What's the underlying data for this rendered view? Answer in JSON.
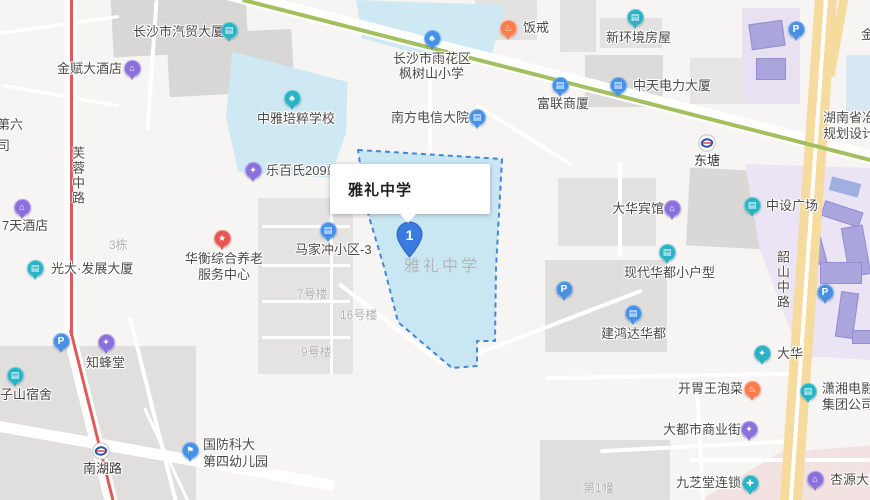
{
  "map": {
    "selected_poi": {
      "tooltip_label": "雅礼中学",
      "marker_number": "1",
      "campus_ghost_label": "雅礼中学"
    },
    "colors": {
      "teal": "#2ab3c4",
      "blue": "#4691e8",
      "purple": "#8a70dd",
      "red": "#e8544f",
      "orange": "#fa7c4b",
      "parking": "#4a90e2",
      "campus_fill": "#c9e6f3",
      "campus_border": "#4287d6",
      "metro_line_green": "#a3bf5f",
      "road_yellow": "#f6db9e",
      "route_red": "#e05a58"
    },
    "pois": [
      {
        "name": "qimao-building",
        "icon": {
          "x": 229,
          "y": 30,
          "color": "teal",
          "glyph": "building"
        },
        "lines": [
          {
            "t": "长沙市汽贸大厦",
            "x": 133,
            "y": 24
          }
        ]
      },
      {
        "name": "jinfu-hotel",
        "icon": {
          "x": 132,
          "y": 68,
          "color": "purple",
          "glyph": "hotel"
        },
        "lines": [
          {
            "t": "金赋大酒店",
            "x": 57,
            "y": 61
          }
        ]
      },
      {
        "name": "fanjie",
        "icon": {
          "x": 508,
          "y": 28,
          "color": "orange",
          "glyph": "food"
        },
        "lines": [
          {
            "t": "饭戒",
            "x": 523,
            "y": 20
          }
        ]
      },
      {
        "name": "xinhuanjing-house",
        "icon": {
          "x": 635,
          "y": 17,
          "color": "teal",
          "glyph": "building"
        },
        "lines": [
          {
            "t": "新环境房屋",
            "x": 606,
            "y": 30
          }
        ]
      },
      {
        "name": "fengshushan-school",
        "icon": {
          "x": 432,
          "y": 38,
          "color": "blue",
          "glyph": "school"
        },
        "lines": [
          {
            "t": "长沙市雨花区",
            "x": 393,
            "y": 51
          },
          {
            "t": "枫树山小学",
            "x": 399,
            "y": 66
          }
        ]
      },
      {
        "name": "fulian-building",
        "icon": {
          "x": 560,
          "y": 85,
          "color": "blue",
          "glyph": "building"
        },
        "lines": [
          {
            "t": "富联商厦",
            "x": 537,
            "y": 96
          }
        ]
      },
      {
        "name": "zhongtian-power",
        "icon": {
          "x": 618,
          "y": 85,
          "color": "blue",
          "glyph": "building"
        },
        "lines": [
          {
            "t": "中天电力大厦",
            "x": 633,
            "y": 78
          }
        ]
      },
      {
        "name": "hunan-institute",
        "lines": [
          {
            "t": "湖南省冶",
            "x": 823,
            "y": 110
          },
          {
            "t": "规划设计",
            "x": 823,
            "y": 126
          }
        ]
      },
      {
        "name": "zhongya-school",
        "icon": {
          "x": 292,
          "y": 98,
          "color": "teal",
          "glyph": "school"
        },
        "lines": [
          {
            "t": "中雅培粹学校",
            "x": 257,
            "y": 111
          }
        ]
      },
      {
        "name": "nanfang-telecom",
        "icon": {
          "x": 477,
          "y": 117,
          "color": "blue",
          "glyph": "building"
        },
        "lines": [
          {
            "t": "南方电信大院",
            "x": 391,
            "y": 110
          }
        ]
      },
      {
        "name": "lebaishi-209",
        "icon": {
          "x": 253,
          "y": 170,
          "color": "purple",
          "glyph": "shop"
        },
        "lines": [
          {
            "t": "乐百氏209站",
            "x": 266,
            "y": 163
          }
        ]
      },
      {
        "name": "dahua-hotel",
        "icon": {
          "x": 672,
          "y": 208,
          "color": "purple",
          "glyph": "hotel"
        },
        "lines": [
          {
            "t": "大华宾馆",
            "x": 612,
            "y": 201
          }
        ]
      },
      {
        "name": "zhongshe-plaza",
        "icon": {
          "x": 752,
          "y": 205,
          "color": "teal",
          "glyph": "building"
        },
        "lines": [
          {
            "t": "中设广场",
            "x": 766,
            "y": 198
          }
        ]
      },
      {
        "name": "majiachong-3",
        "icon": {
          "x": 328,
          "y": 230,
          "color": "blue",
          "glyph": "building"
        },
        "lines": [
          {
            "t": "马家冲小区-3",
            "x": 295,
            "y": 242
          }
        ]
      },
      {
        "name": "xiandai-huadu",
        "icon": {
          "x": 667,
          "y": 252,
          "color": "teal",
          "glyph": "building"
        },
        "lines": [
          {
            "t": "现代华都小户型",
            "x": 624,
            "y": 265
          }
        ]
      },
      {
        "name": "huaheng-center",
        "icon": {
          "x": 222,
          "y": 238,
          "color": "red",
          "glyph": "star"
        },
        "lines": [
          {
            "t": "华衡综合养老",
            "x": 185,
            "y": 251
          },
          {
            "t": "服务中心",
            "x": 198,
            "y": 267
          }
        ]
      },
      {
        "name": "guangda-building",
        "icon": {
          "x": 35,
          "y": 268,
          "color": "teal",
          "glyph": "building"
        },
        "lines": [
          {
            "t": "光大·发展大厦",
            "x": 51,
            "y": 261
          }
        ]
      },
      {
        "name": "7days-hotel",
        "icon": {
          "x": 22,
          "y": 207,
          "color": "purple",
          "glyph": "hotel"
        },
        "lines": [
          {
            "t": "7天酒店",
            "x": 2,
            "y": 218
          }
        ]
      },
      {
        "name": "zhifengtang",
        "icon": {
          "x": 106,
          "y": 342,
          "color": "purple",
          "glyph": "shop"
        },
        "lines": [
          {
            "t": "知蜂堂",
            "x": 86,
            "y": 355
          }
        ]
      },
      {
        "name": "zishan-dorm",
        "icon": {
          "x": 15,
          "y": 375,
          "color": "teal",
          "glyph": "building"
        },
        "lines": [
          {
            "t": "子山宿舍",
            "x": 0,
            "y": 387
          }
        ]
      },
      {
        "name": "jianhongda-huadu",
        "icon": {
          "x": 633,
          "y": 313,
          "color": "blue",
          "glyph": "building"
        },
        "lines": [
          {
            "t": "建鸿达华都",
            "x": 601,
            "y": 326
          }
        ]
      },
      {
        "name": "dahua",
        "icon": {
          "x": 762,
          "y": 353,
          "color": "teal",
          "glyph": "shop"
        },
        "lines": [
          {
            "t": "大华",
            "x": 777,
            "y": 346
          }
        ]
      },
      {
        "name": "kaiweiwang-paocai",
        "icon": {
          "x": 752,
          "y": 389,
          "color": "orange",
          "glyph": "food"
        },
        "lines": [
          {
            "t": "开胃王泡菜",
            "x": 678,
            "y": 381
          }
        ]
      },
      {
        "name": "xiaoxiang-film",
        "icon": {
          "x": 808,
          "y": 391,
          "color": "teal",
          "glyph": "building"
        },
        "lines": [
          {
            "t": "潇湘电影",
            "x": 822,
            "y": 381
          },
          {
            "t": "集团公司",
            "x": 822,
            "y": 397
          }
        ]
      },
      {
        "name": "dadushi-street",
        "icon": {
          "x": 749,
          "y": 429,
          "color": "purple",
          "glyph": "shop"
        },
        "lines": [
          {
            "t": "大都市商业街",
            "x": 663,
            "y": 422
          }
        ]
      },
      {
        "name": "jiuzhitang",
        "icon": {
          "x": 750,
          "y": 483,
          "color": "teal",
          "glyph": "pharmacy"
        },
        "lines": [
          {
            "t": "九芝堂连锁",
            "x": 676,
            "y": 475
          }
        ]
      },
      {
        "name": "xingyuan-hotel",
        "icon": {
          "x": 815,
          "y": 479,
          "color": "purple",
          "glyph": "hotel"
        },
        "lines": [
          {
            "t": "杏源大酒店",
            "x": 830,
            "y": 472
          }
        ]
      },
      {
        "name": "guofangkeda-kindergarten",
        "icon": {
          "x": 190,
          "y": 450,
          "color": "blue",
          "glyph": "flag"
        },
        "lines": [
          {
            "t": "国防科大",
            "x": 203,
            "y": 437
          },
          {
            "t": "第四幼儿园",
            "x": 203,
            "y": 454
          }
        ]
      },
      {
        "name": "no6-partial",
        "lines": [
          {
            "t": "第六",
            "x": -3,
            "y": 117
          },
          {
            "t": "司",
            "x": -3,
            "y": 138
          }
        ]
      },
      {
        "name": "jin-partial",
        "lines": [
          {
            "t": "金",
            "x": 861,
            "y": 27
          }
        ]
      }
    ],
    "metro_stations": [
      {
        "name": "dongtang",
        "x": 707,
        "y": 143,
        "label": "东塘",
        "lx": 694,
        "ly": 153
      },
      {
        "name": "nanhu-road",
        "x": 101,
        "y": 451,
        "label": "南湖路",
        "lx": 83,
        "ly": 461
      }
    ],
    "parking_icons": [
      {
        "x": 796,
        "y": 29
      },
      {
        "x": 564,
        "y": 289
      },
      {
        "x": 825,
        "y": 292
      },
      {
        "x": 61,
        "y": 341
      }
    ],
    "road_labels": [
      {
        "name": "furong-middle-road",
        "text": "芙蓉中路",
        "x": 68,
        "y": 146,
        "vertical": true
      },
      {
        "name": "shaoshan-middle-road",
        "text": "韶山中路",
        "x": 773,
        "y": 250,
        "vertical": true
      }
    ],
    "area_labels": [
      {
        "name": "building-3dong",
        "text": "3栋",
        "x": 109,
        "y": 236
      },
      {
        "name": "building-7",
        "text": "7号楼",
        "x": 297,
        "y": 285
      },
      {
        "name": "building-16",
        "text": "16号楼",
        "x": 340,
        "y": 306
      },
      {
        "name": "building-9",
        "text": "9号楼",
        "x": 301,
        "y": 343
      },
      {
        "name": "building-1zhuang",
        "text": "第1幢",
        "x": 583,
        "y": 479
      }
    ]
  }
}
